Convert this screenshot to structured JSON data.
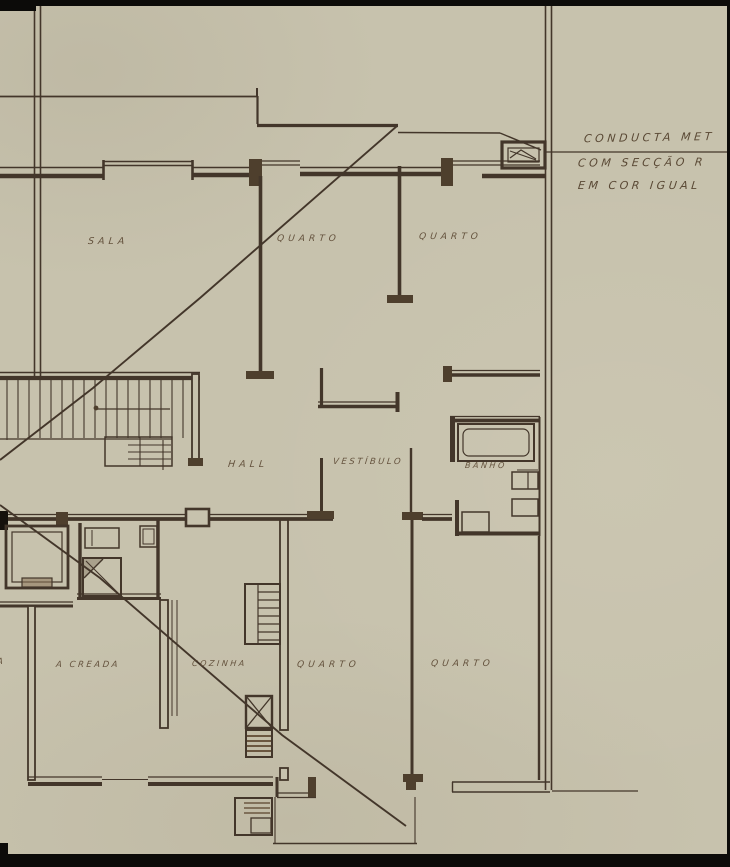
{
  "rooms": {
    "sala": "SALA",
    "quarto_top_left": "QUARTO",
    "quarto_top_right": "QUARTO",
    "hall": "HALL",
    "vestibulo": "VESTÍBULO",
    "banho": "BANHO",
    "creada": "A CREADA",
    "cozinha": "COZINHA",
    "quarto_bottom_left": "QUARTO",
    "quarto_bottom_right": "QUARTO",
    "partial_left": "A"
  },
  "annotation": {
    "line1": "CONDUCTA MET",
    "line2": "COM SECÇÃO R",
    "line3": "EM COR IGUAL"
  },
  "colors": {
    "paper": "#c7c2ad",
    "ink_dark": "#43362a",
    "ink_light": "#6a5843",
    "frame_black": "#0c0b09"
  }
}
